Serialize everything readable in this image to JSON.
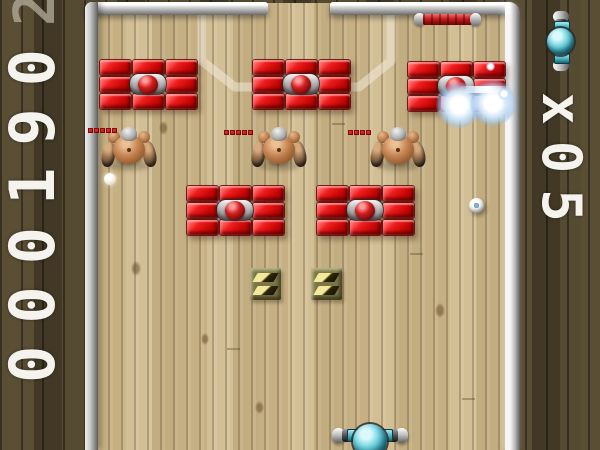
{
  "hud": {
    "score": {
      "value": "000190",
      "dim_overflow_digit": "2"
    },
    "lives": {
      "label": "x05",
      "icon": "paddle-icon"
    }
  },
  "colors": {
    "brick_red": "#ef1d1d",
    "core_dome_red": "#d22020",
    "teal_accent": "#4fc8d6",
    "olive_tile": "#7c7646",
    "floor_wood": "#cbb689",
    "dark_wood": "#4e432c",
    "frame_silver": "#c8c8c8",
    "hud_text": "#f5f3ee",
    "health_pip_red": "#c81e1e"
  },
  "playfield": {
    "brick_groups": [
      {
        "x": 100,
        "y": 60,
        "state": "intact"
      },
      {
        "x": 253,
        "y": 60,
        "state": "intact"
      },
      {
        "x": 408,
        "y": 62,
        "state": "being-hit"
      },
      {
        "x": 187,
        "y": 186,
        "state": "intact"
      },
      {
        "x": 317,
        "y": 186,
        "state": "intact"
      }
    ],
    "robots": [
      {
        "x": 100,
        "y": 127,
        "health_segments": 5,
        "bar_x": 88,
        "bar_y": 128
      },
      {
        "x": 250,
        "y": 127,
        "health_segments": 5,
        "bar_x": 224,
        "bar_y": 130
      },
      {
        "x": 369,
        "y": 127,
        "health_segments": 4,
        "bar_x": 348,
        "bar_y": 130
      }
    ],
    "olive_tiles": [
      {
        "x": 250,
        "y": 268
      },
      {
        "x": 311,
        "y": 268
      }
    ],
    "balls": [
      {
        "x": 104,
        "y": 173,
        "d": 12,
        "style": "soft"
      },
      {
        "x": 469,
        "y": 198,
        "d": 15,
        "style": "shiny"
      }
    ],
    "explosions": [
      {
        "x": 436,
        "y": 82,
        "d": 46
      },
      {
        "x": 470,
        "y": 80,
        "d": 46
      }
    ],
    "flashes": [
      {
        "type": "streak",
        "x": 458,
        "y": 86,
        "w": 54,
        "h": 7
      },
      {
        "type": "spark",
        "x": 498,
        "y": 88,
        "d": 12
      },
      {
        "type": "spark",
        "x": 486,
        "y": 62,
        "d": 9
      }
    ],
    "paddle": {
      "x": 332,
      "y": 421
    },
    "pickup_rod": {
      "x": 414,
      "y": 13
    }
  }
}
